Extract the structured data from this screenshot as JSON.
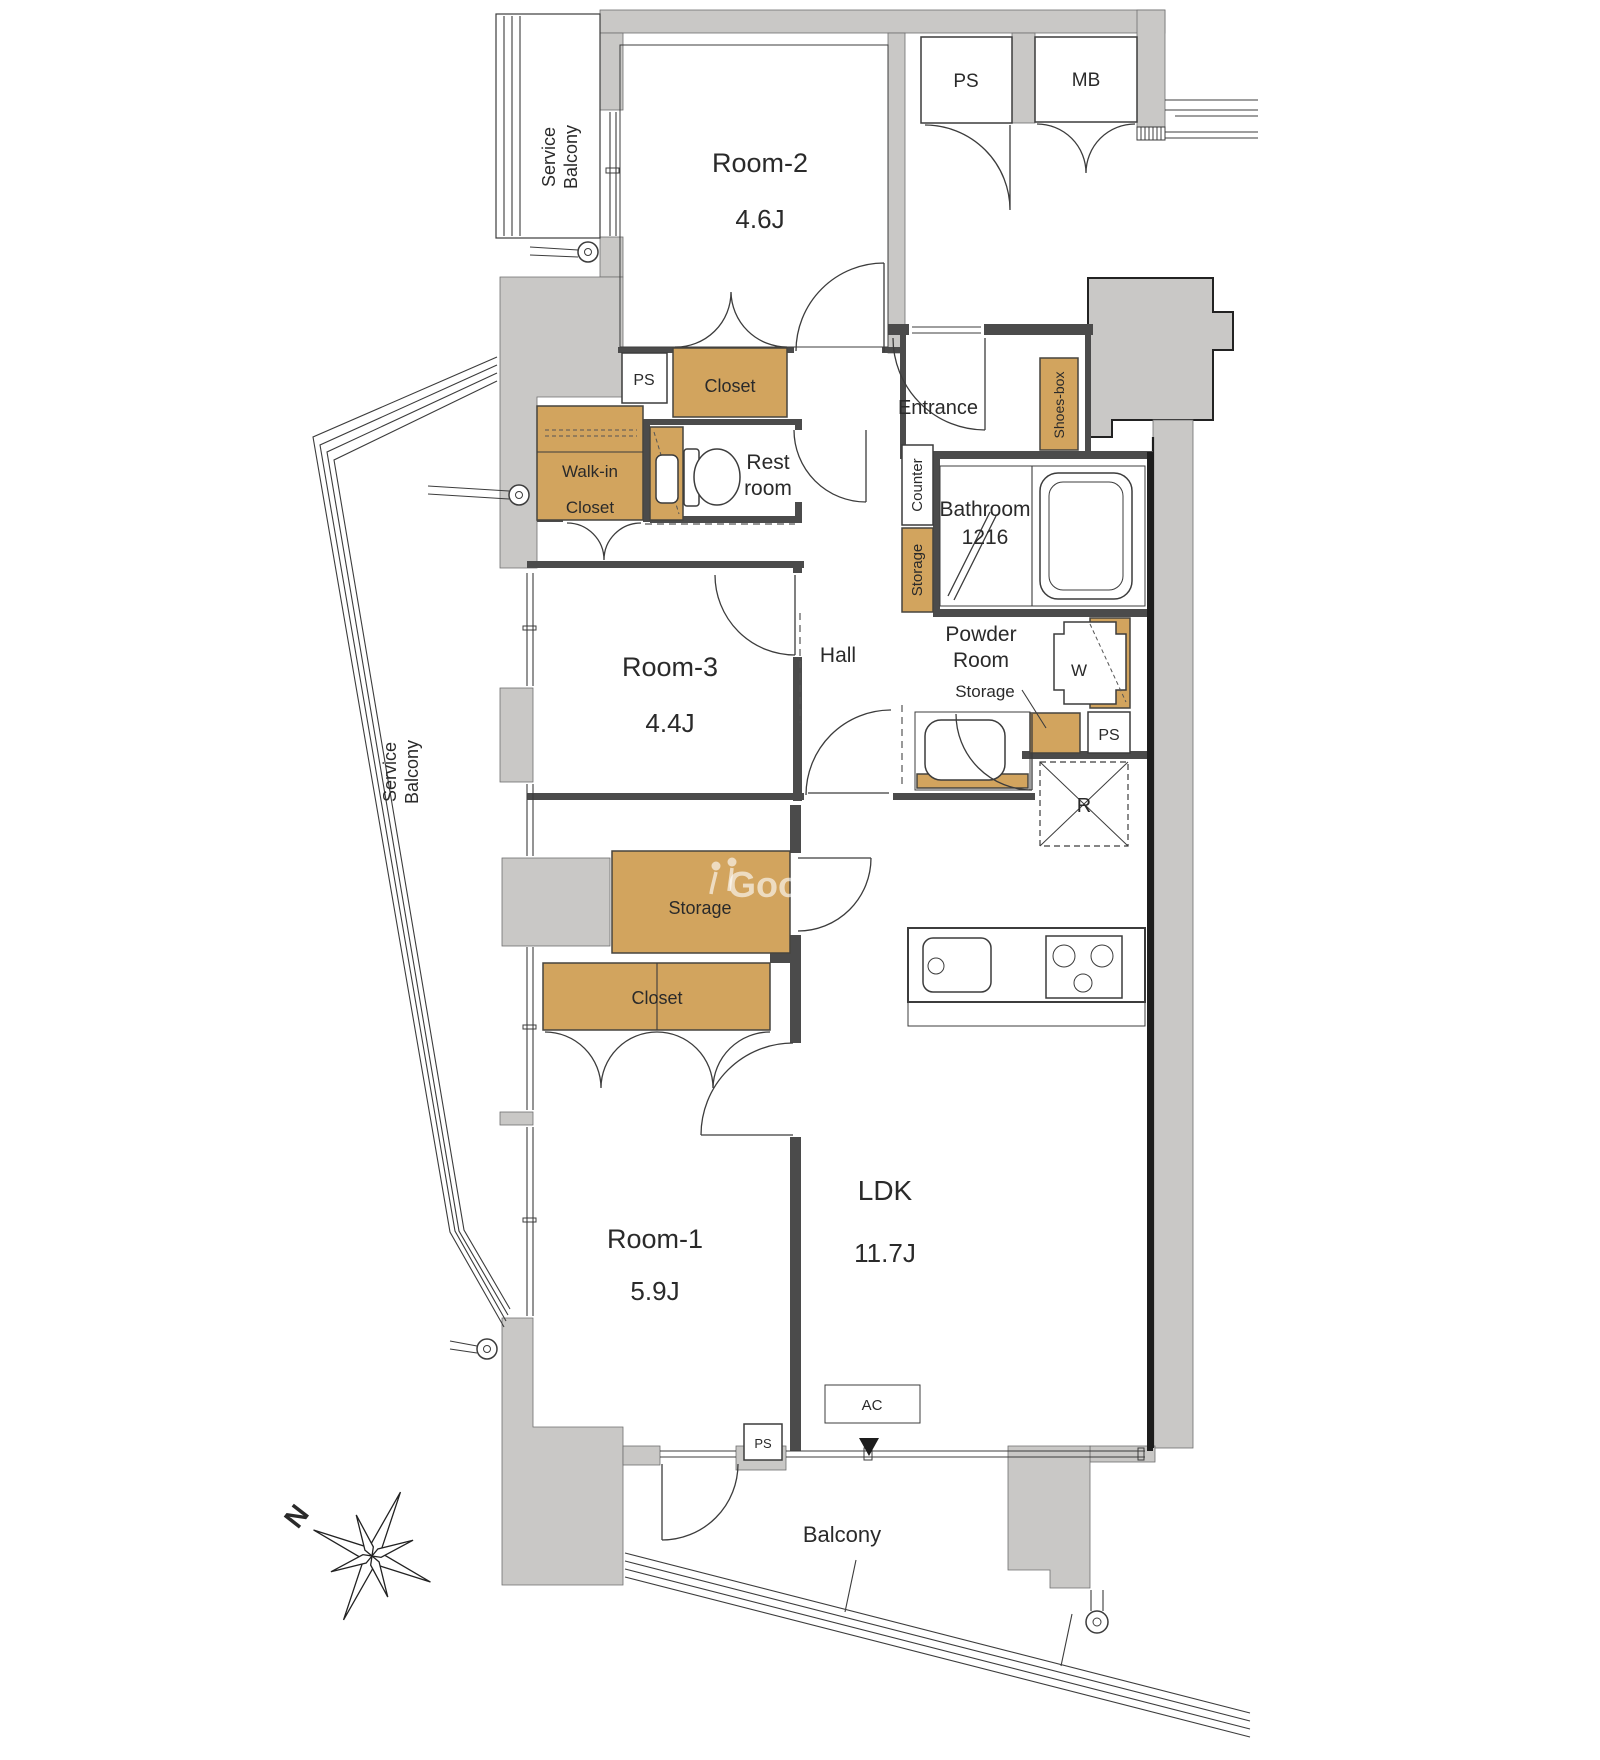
{
  "labels": {
    "service_balcony_l1": "Service",
    "service_balcony_l2": "Balcony",
    "room2_name": "Room-2",
    "room2_area": "4.6J",
    "ps_top": "PS",
    "mb": "MB",
    "closet_room2": "Closet",
    "ps_hall": "PS",
    "walkin_l1": "Walk-in",
    "walkin_l2": "Closet",
    "restroom_l1": "Rest",
    "restroom_l2": "room",
    "entrance": "Entrance",
    "shoes_box": "Shoes-box",
    "counter": "Counter",
    "bathroom_name": "Bathroom",
    "bathroom_size": "1216",
    "storage_hall": "Storage",
    "hall": "Hall",
    "room3_name": "Room-3",
    "room3_area": "4.4J",
    "powder_l1": "Powder",
    "powder_l2": "Room",
    "storage_powder": "Storage",
    "washer": "W",
    "ps_powder": "PS",
    "fridge": "R",
    "storage_mid": "Storage",
    "closet_room1": "Closet",
    "room1_name": "Room-1",
    "room1_area": "5.9J",
    "ldk_name": "LDK",
    "ldk_area": "11.7J",
    "ac": "AC",
    "ps_bottom": "PS",
    "balcony": "Balcony",
    "north": "N",
    "watermark": "Goo"
  },
  "colors": {
    "wall_fill": "#c9c8c6",
    "interior_wall": "#4b4b4b",
    "outline": "#1d1d1d",
    "closet_fill": "#d2a45e",
    "closet_border": "#46443f",
    "line": "#3c3c3c",
    "text": "#2a2a2a",
    "background": "#ffffff"
  }
}
